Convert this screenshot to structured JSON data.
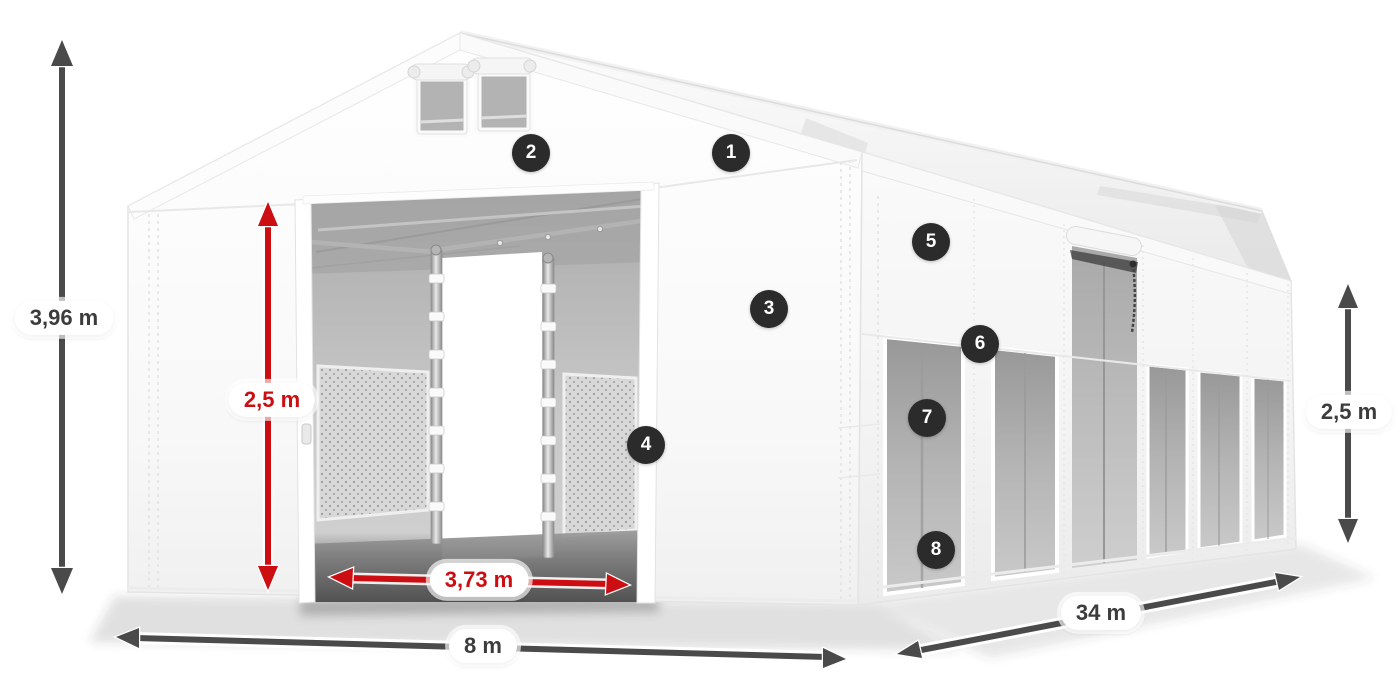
{
  "scene": {
    "alt": "White PVC storage tent in three-quarter view with numbered feature hotspots and dimension arrows",
    "background_color": "#ffffff"
  },
  "palette": {
    "arrow_dark": "#4a4a4a",
    "dimension_red": "#cc0d11",
    "pill_background": "#ffffff",
    "pill_text_dark": "#3c3c3c",
    "hotspot_background": "#2b2b2b",
    "hotspot_text": "#ffffff",
    "tent_white": "#f7f7f7",
    "interior_gray": "#c2c2c2"
  },
  "dimensions": [
    {
      "id": "total-height",
      "label": "3,96 m",
      "style": "dark"
    },
    {
      "id": "entrance-height",
      "label": "2,5 m",
      "style": "red"
    },
    {
      "id": "entrance-width",
      "label": "3,73 m",
      "style": "red"
    },
    {
      "id": "gable-width",
      "label": "8 m",
      "style": "dark"
    },
    {
      "id": "length",
      "label": "34 m",
      "style": "dark"
    },
    {
      "id": "side-height",
      "label": "2,5 m",
      "style": "dark"
    }
  ],
  "hotspots": [
    {
      "label": "1"
    },
    {
      "label": "2"
    },
    {
      "label": "3"
    },
    {
      "label": "4"
    },
    {
      "label": "5"
    },
    {
      "label": "6"
    },
    {
      "label": "7"
    },
    {
      "label": "8"
    }
  ]
}
